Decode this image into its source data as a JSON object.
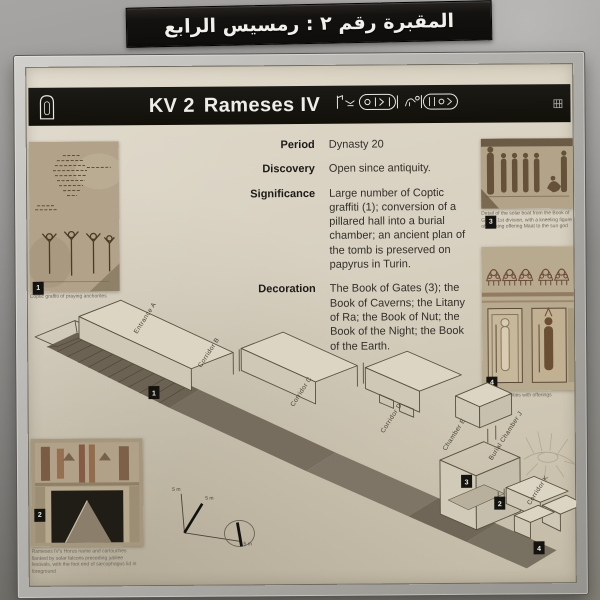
{
  "banner": {
    "title_arabic": "المقبرة رقم ٢ : رمسيس الرابع"
  },
  "sign": {
    "header": {
      "code": "KV 2",
      "name": "Rameses IV",
      "hieroglyphs_icon": "royal-name-cartouches"
    },
    "info": {
      "rows": [
        {
          "label": "Period",
          "value": "Dynasty 20"
        },
        {
          "label": "Discovery",
          "value": "Open since antiquity."
        },
        {
          "label": "Significance",
          "value": "Large number of Coptic graffiti (1); conversion of a pillared hall into a burial chamber; an ancient plan of the tomb is preserved on papyrus in Turin."
        },
        {
          "label": "Decoration",
          "value": "The Book of Gates (3); the Book of Caverns; the Litany of Ra; the Book of Nut; the Book of the Night; the Book of the Earth."
        }
      ]
    },
    "photos": [
      {
        "number": "1",
        "caption": "Coptic graffiti of praying anchorites"
      },
      {
        "number": "2",
        "caption": "Rameses IV's Horus name and cartouches flanked by solar falcons preceding jubilee festivals, with the foot end of sarcophagus lid in foreground"
      },
      {
        "number": "3",
        "caption": "Detail of the solar boat from the Book of Gates, 1st division, with a kneeling figure of the king offering Maat to the sun god"
      },
      {
        "number": "4",
        "caption": "Enshrined deities with offerings"
      }
    ],
    "diagram": {
      "labels": {
        "entrance": "Entrance A",
        "corridor_b": "Corridor B",
        "corridor_c": "Corridor C",
        "corridor_d": "Corridor D",
        "chamber_e": "Chamber E",
        "burial_chamber": "Burial Chamber J",
        "corridor_k": "Corridor K"
      },
      "markers": [
        "1",
        "2",
        "3",
        "4"
      ],
      "scale_label": "5 m"
    }
  },
  "colors": {
    "banner_black": "#141210",
    "header_black": "#15130f",
    "panel_cream": "#d8d1c1",
    "photo_sepia": "#b1a289",
    "diagram_shadow": "#6b6253"
  }
}
